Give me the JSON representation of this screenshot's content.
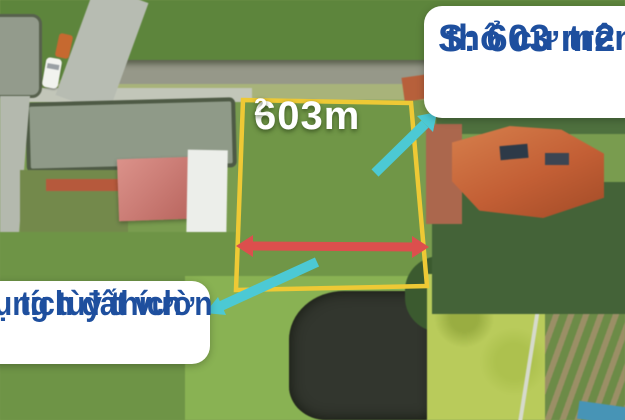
{
  "plot_overlay": {
    "area_label": "603m",
    "area_sup": "2",
    "outline_color": "#eec935",
    "width_arrow_color": "#dc4f4d",
    "pointer_arrow_color": "#4cc9d4"
  },
  "callouts": {
    "top_right": {
      "line1": "S: 603 m2",
      "line2": "thổ cư trên",
      "text_color": "#1e4f9e",
      "bg": "#ffffff"
    },
    "bottom_left": {
      "line1": "tích đất vườn",
      "line2": "ụng tùy thích",
      "text_color": "#1e4f9e",
      "bg": "#ffffff"
    }
  }
}
